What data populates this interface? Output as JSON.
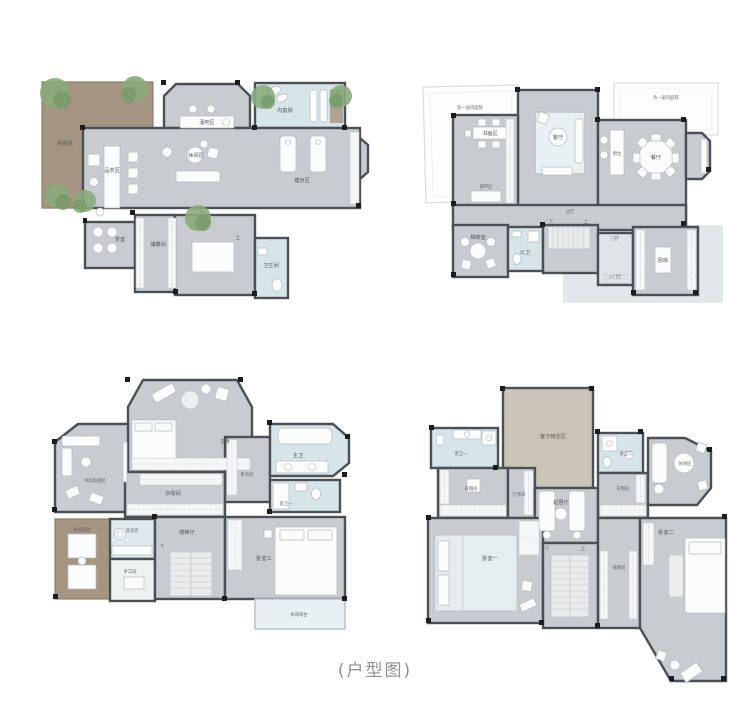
{
  "caption": "(户型图)",
  "colors": {
    "floor_gray": "#c8ccd0",
    "wall_dark": "#4a5056",
    "courtyard_brown": "#a59480",
    "water_blue": "#d6e5ea",
    "void_beige": "#cbc5b7",
    "tree_green": "#8aab7b",
    "caption_gray": "#8f8f8f"
  },
  "plans": {
    "basement": {
      "labels": {
        "courtyard_left": "内庭院",
        "pool_courtyard": "内庭院",
        "bar": "酒吧区",
        "tea_table": "品茶区",
        "lounge": "休闲区",
        "gym": "健身区",
        "tea_room": "茶室",
        "storage": "储藏间",
        "bathroom": "卫生间",
        "stair_up": "上"
      }
    },
    "first": {
      "labels": {
        "void_left": "负一层内庭院",
        "void_right": "负一层内庭院",
        "study": "书画区",
        "living": "客厅",
        "piano": "钢琴区",
        "corridor": "过厅",
        "bar": "吧台",
        "dining": "餐厅",
        "mahjong": "棋牌室",
        "bath": "公卫",
        "hall": "门厅",
        "foyer": "入门厅",
        "kitchen": "厨房",
        "stair_down": "下",
        "stair_up": "上"
      }
    },
    "second": {
      "labels": {
        "master": "主卧",
        "tv_lounge": "休闲电视区",
        "closet": "衣帽间",
        "dressing": "更衣间",
        "master_bath": "主卫",
        "guest_bath": "客卫一",
        "terrace": "休闲露台",
        "laundry": "洗衣房",
        "craft": "手工间",
        "stair_hall": "楼梯厅",
        "bedroom3": "卧室三",
        "balcony": "休闲阳台",
        "stair_down": "下"
      }
    },
    "third": {
      "labels": {
        "void": "客厅挑空区",
        "bath1": "客卫一",
        "bath2": "客卫二",
        "closet_left": "衣帽间",
        "closet_right": "衣帽间",
        "luggage": "行李间",
        "sitting": "起居厅",
        "lounge": "休闲区",
        "bedroom1": "卧室一",
        "bedroom2": "卧室二",
        "storage": "储物间",
        "stair_down": "下",
        "stair_up": "上"
      }
    }
  }
}
